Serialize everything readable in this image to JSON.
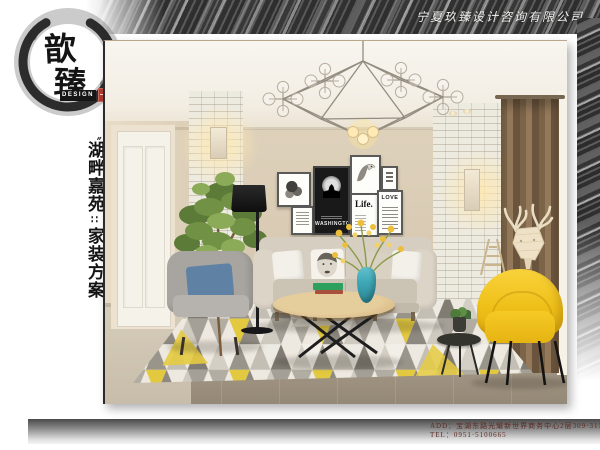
{
  "header": {
    "company_name": "宁夏玖臻设计咨询有限公司"
  },
  "logo": {
    "char_top": "歆",
    "char_bottom": "臻",
    "sub_label": "DESIGN"
  },
  "side_title": {
    "open_mark": "〝",
    "line1": "湖畔嘉苑",
    "separator": "∷",
    "line2": "家装方案"
  },
  "photo": {
    "posters": {
      "washington": "WASHINGTON",
      "life": "Life.",
      "love": "LOVE"
    }
  },
  "footer": {
    "add_label": "ADD：",
    "address": "宝湖东路光耀新世界商务中心2层309·311室",
    "tel_label": "TEL：",
    "tel": "0951·5100665"
  },
  "colors": {
    "accent_yellow": "#f2c41a",
    "vase_teal": "#3fa9b8",
    "curtain_brown": "#8b7154",
    "band_dark": "#3c3c3c",
    "footer_text": "#5e2a22",
    "seal_red": "#b43a2e"
  }
}
